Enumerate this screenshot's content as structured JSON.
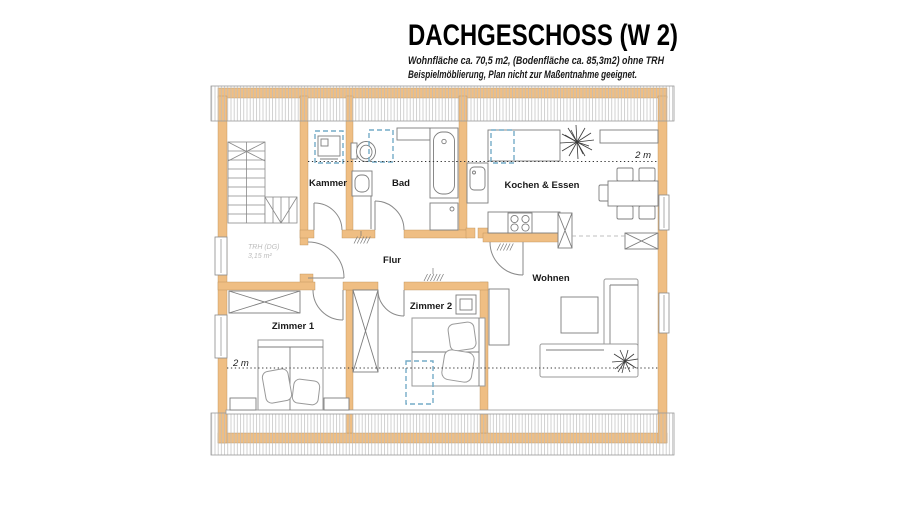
{
  "header": {
    "title": "DACHGESCHOSS (W 2)",
    "subtitle1": "Wohnfläche ca. 70,5 m2, (Bodenfläche ca. 85,3m2) ohne TRH",
    "subtitle2": "Beispielmöblierung, Plan nicht zur Maßentnahme geeignet."
  },
  "rooms": {
    "kammer": "Kammer",
    "bad": "Bad",
    "kochen": "Kochen & Essen",
    "flur": "Flur",
    "wohnen": "Wohnen",
    "zimmer1": "Zimmer 1",
    "zimmer2": "Zimmer 2"
  },
  "annotations": {
    "height_top": "2 m",
    "height_bottom": "2 m",
    "trh1": "TRH (DG)",
    "trh2": "3,15 m²"
  },
  "colors": {
    "wall": "#EFBE83",
    "roof_window": "#74ACC7",
    "hatch": "#BDBDBD",
    "outline": "#9A9A9A",
    "muted": "#BDBDBD"
  }
}
